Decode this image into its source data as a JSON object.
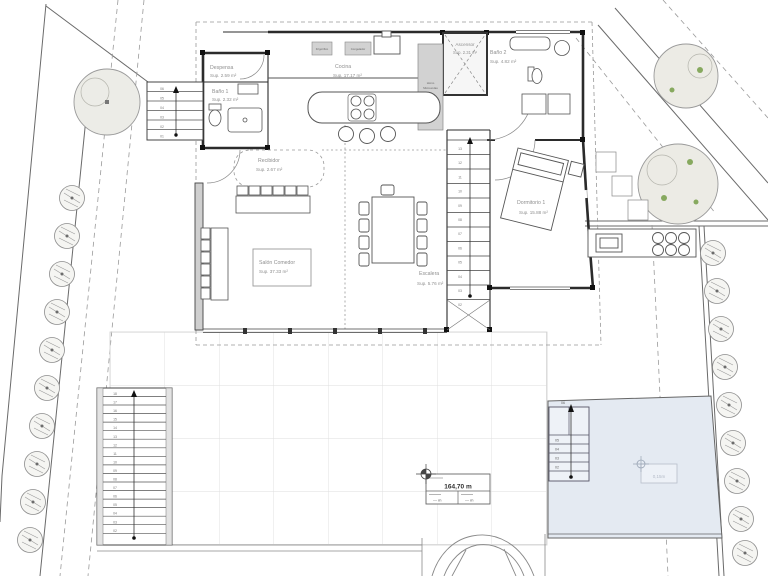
{
  "rooms": [
    {
      "name": "Despensa",
      "area": "Sup. 2.59 m²"
    },
    {
      "name": "Baño 1",
      "area": "Sup. 2.32 m²"
    },
    {
      "name": "Cocina",
      "area": "Sup. 17.17 m²"
    },
    {
      "name": "Ascensor",
      "area": "Sup. 2.31 m²"
    },
    {
      "name": "Baño 2",
      "area": "Sup. 4.82 m²"
    },
    {
      "name": "Recibidor",
      "area": "Sup. 2.67 m²"
    },
    {
      "name": "Salón Comedor",
      "area": "Sup. 37.33 m²"
    },
    {
      "name": "Escalera",
      "area": "Sup. 5.76 m²"
    },
    {
      "name": "Dormitorio 1",
      "area": "Sup. 15.88 m²"
    }
  ],
  "appliances": {
    "fridge": "Frigorífico",
    "freezer": "Congelador",
    "oven_line1": "Horno",
    "oven_line2": "Microondas"
  },
  "levels": {
    "terrain": "164,70 m",
    "sub_left": "— m",
    "sub_right": "— m",
    "pool": "0,15m"
  },
  "stairs": {
    "entry_steps": [
      "06",
      "05",
      "04",
      "03",
      "02",
      "01"
    ],
    "left_steps": [
      "18",
      "17",
      "16",
      "15",
      "14",
      "13",
      "12",
      "11",
      "10",
      "09",
      "08",
      "07",
      "06",
      "05",
      "04",
      "03",
      "02"
    ],
    "interior_steps": [
      "13",
      "12",
      "11",
      "10",
      "09",
      "08",
      "07",
      "06",
      "05",
      "04",
      "03",
      "02"
    ],
    "pool_top": "06",
    "pool_steps": [
      "05",
      "04",
      "03",
      "02"
    ]
  },
  "colors": {
    "wall": "#2b2b2b",
    "line": "#555555",
    "muted": "#999999",
    "label": "#8f8f8f",
    "pool_fill": "#e4eaf2",
    "appliance_fill": "#d2d2d2",
    "tile_line": "#dedede",
    "tree_fill": "#ececе7",
    "green": "#87a95f"
  }
}
